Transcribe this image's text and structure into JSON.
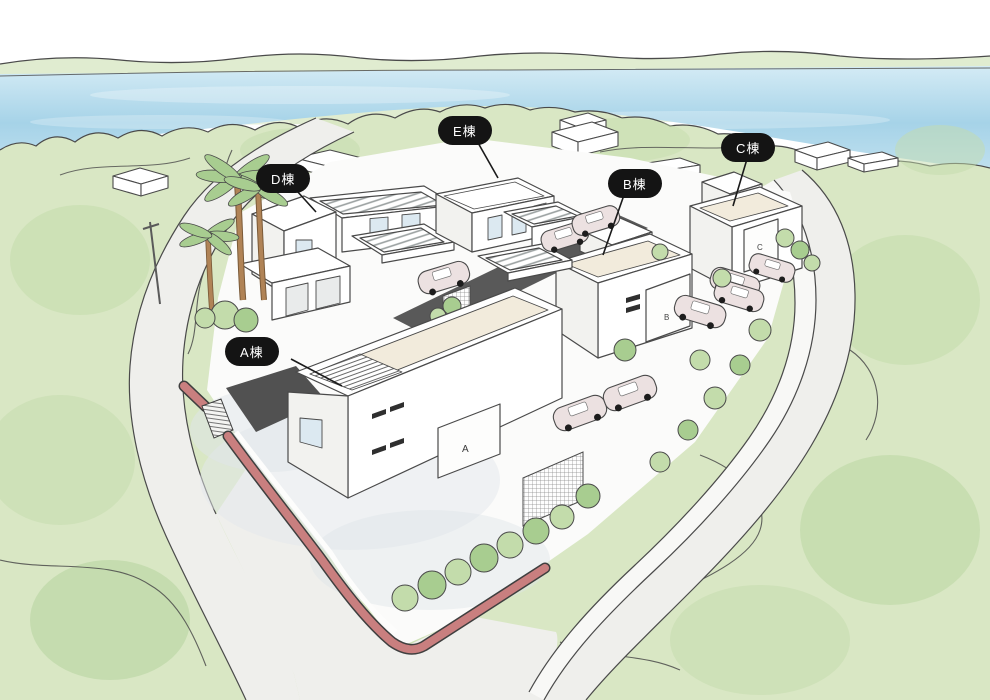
{
  "illustration": {
    "type": "isometric-residential-site-illustration",
    "labels": {
      "a": "A棟",
      "b": "B棟",
      "c": "C棟",
      "d": "D棟",
      "e": "E棟"
    },
    "gate_letters": {
      "a": "A",
      "b": "B",
      "c": "C"
    }
  },
  "colors": {
    "outline": "#4a4a4a",
    "water": "#a9d4e9",
    "water-light": "#d6ecf6",
    "shore-green": "#e0ecd0",
    "green-light": "#d9e7c4",
    "green-mid": "#c3dcab",
    "green-dark": "#a8cd90",
    "road": "#efefec",
    "site": "#fbfbfa",
    "driveway": "#595959",
    "wall-red": "#c97f7f",
    "roof-cream": "#f2ebdc",
    "car-body": "#ece1e1",
    "glass-blue": "#dce9f1",
    "palm-trunk": "#b08356",
    "label-bg": "#141414",
    "label-text": "#ffffff"
  }
}
